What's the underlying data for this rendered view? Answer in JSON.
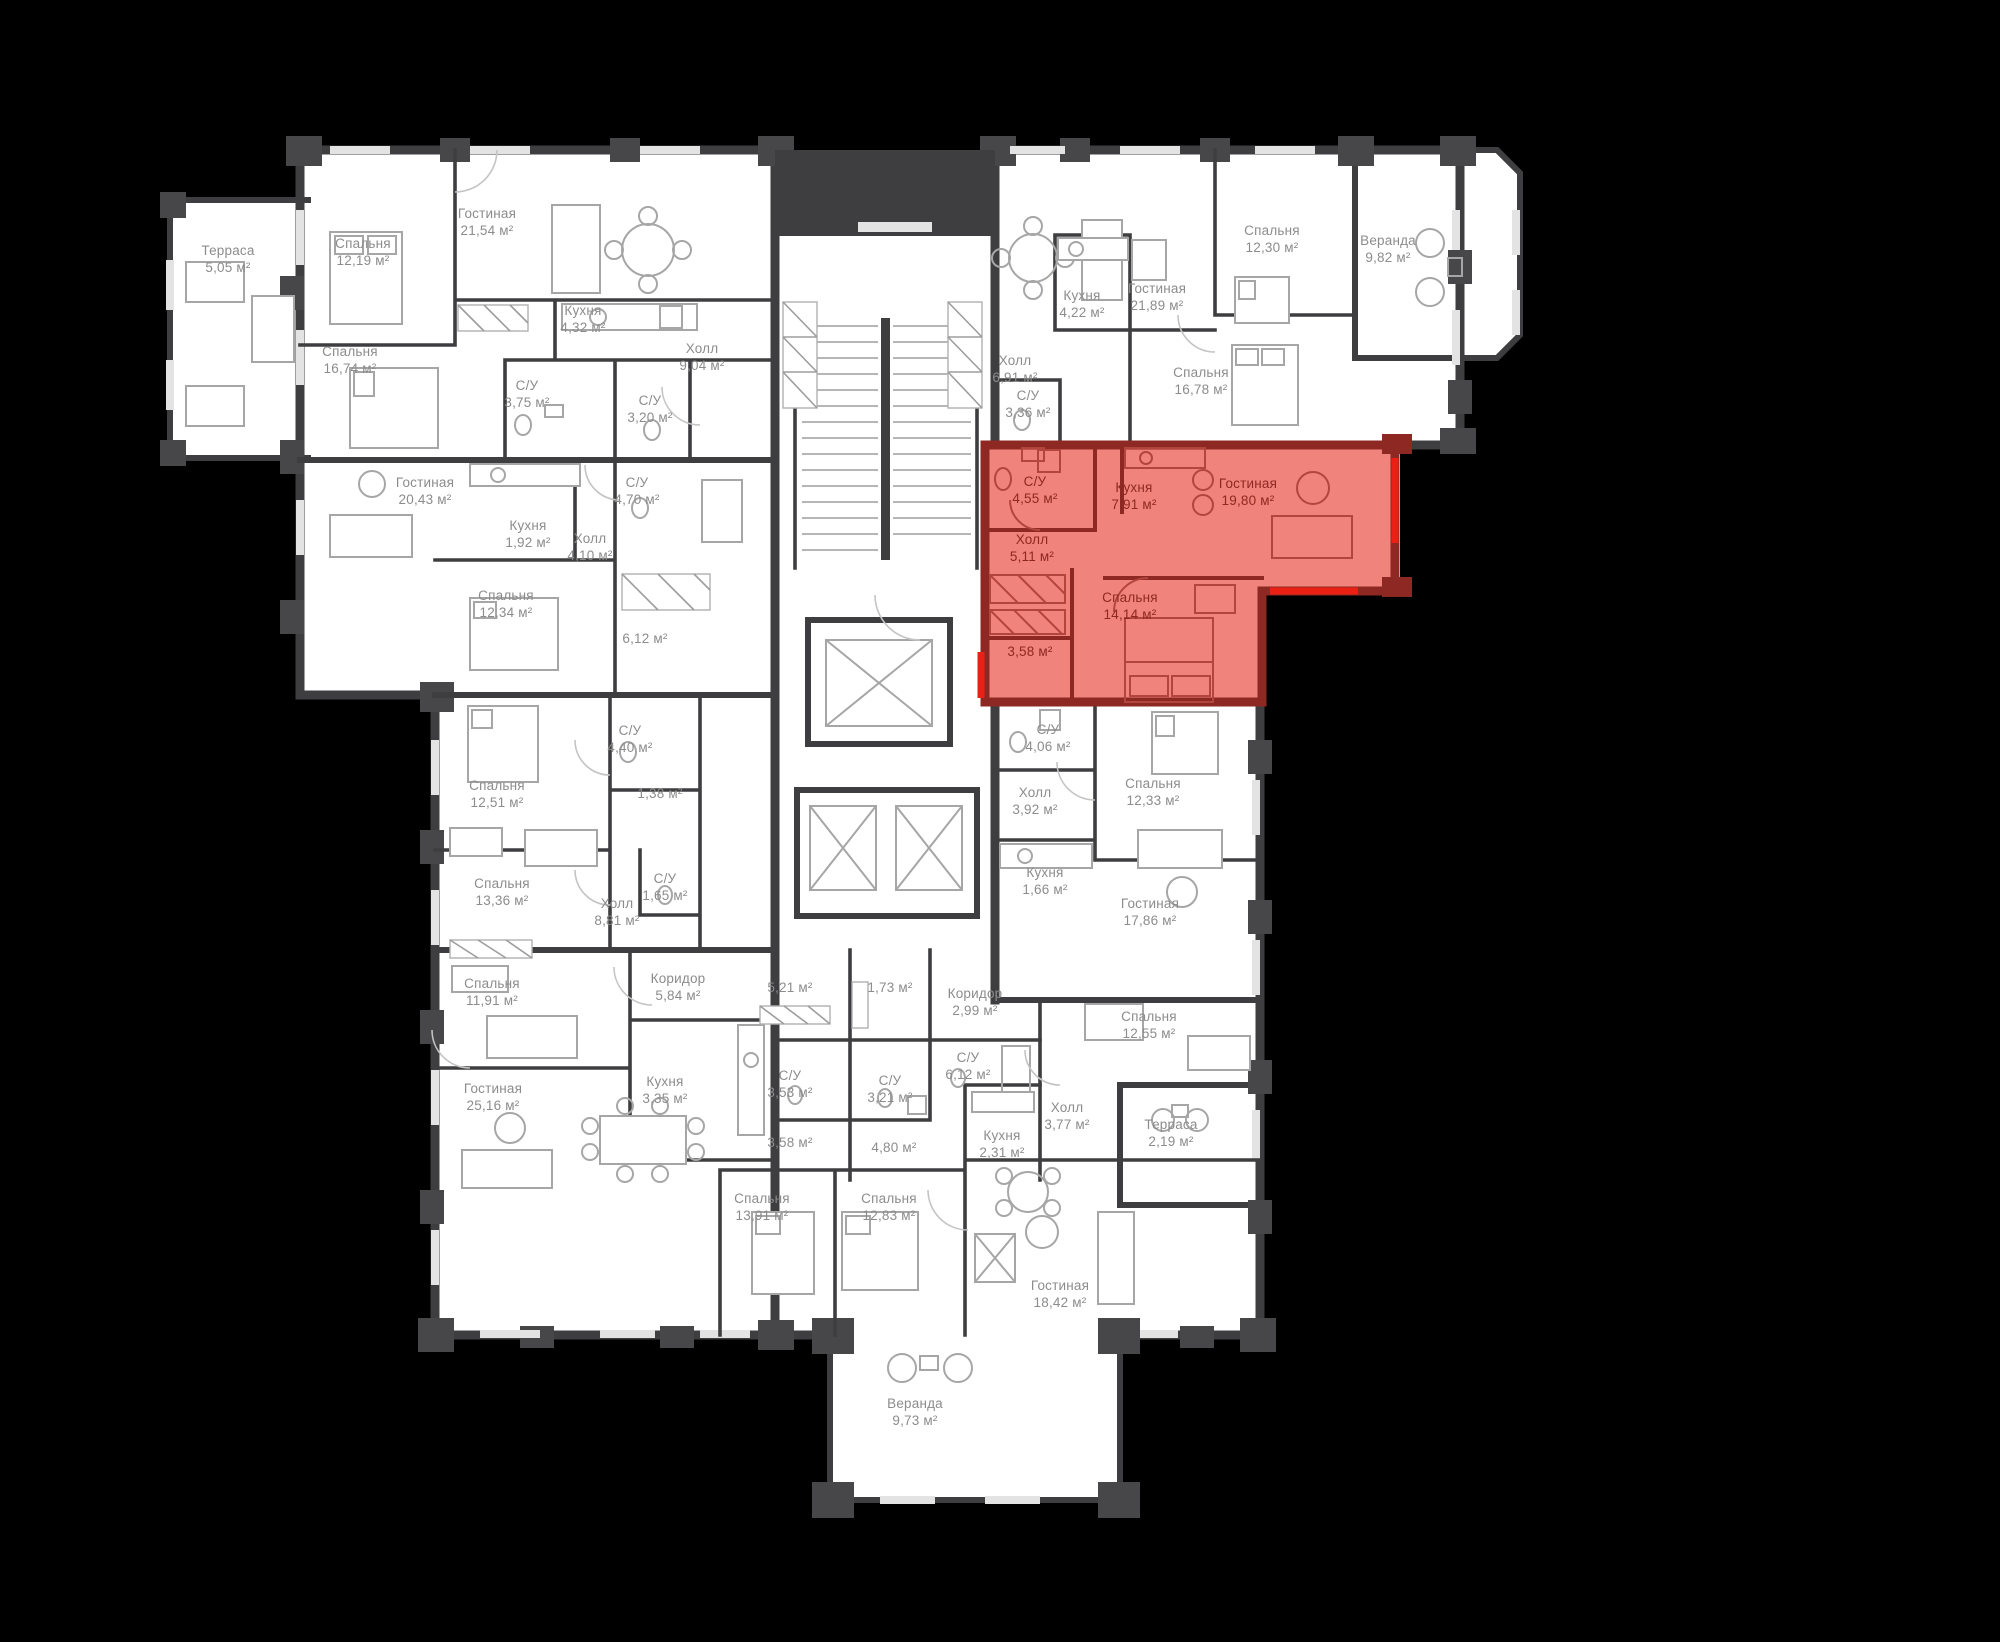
{
  "canvas": {
    "width": 2000,
    "height": 1642,
    "background": "#000000"
  },
  "colors": {
    "background": "#000000",
    "floor_fill": "#ffffff",
    "wall": "#3e3e40",
    "furniture_line": "#a6a6a6",
    "label_text": "#8c8c8c",
    "highlight_fill": "#f0837b",
    "highlight_wall": "#8e2823",
    "highlight_accent": "#ea2015",
    "highlight_label": "#8e2823",
    "highlight_furniture": "#b2453e"
  },
  "rooms": [
    {
      "name": "Терраса",
      "area": "5,05 м²",
      "x": 228,
      "y": 255
    },
    {
      "name": "Спальня",
      "area": "12,19 м²",
      "x": 363,
      "y": 248
    },
    {
      "name": "Гостиная",
      "area": "21,54 м²",
      "x": 487,
      "y": 218
    },
    {
      "name": "Спальня",
      "area": "16,74 м²",
      "x": 350,
      "y": 356
    },
    {
      "name": "Кухня",
      "area": "4,32 м²",
      "x": 583,
      "y": 315
    },
    {
      "name": "Холл",
      "area": "9,04 м²",
      "x": 702,
      "y": 353
    },
    {
      "name": "С/У",
      "area": "3,75 м²",
      "x": 527,
      "y": 390
    },
    {
      "name": "С/У",
      "area": "3,20 м²",
      "x": 650,
      "y": 405
    },
    {
      "name": "Гостиная",
      "area": "20,43 м²",
      "x": 425,
      "y": 487
    },
    {
      "name": "Кухня",
      "area": "1,92 м²",
      "x": 528,
      "y": 530
    },
    {
      "name": "С/У",
      "area": "4,70 м²",
      "x": 637,
      "y": 487
    },
    {
      "name": "Холл",
      "area": "4,10 м²",
      "x": 590,
      "y": 543
    },
    {
      "name": "Спальня",
      "area": "12,34 м²",
      "x": 506,
      "y": 600
    },
    {
      "name": "",
      "area": "6,12 м²",
      "x": 645,
      "y": 643
    },
    {
      "name": "С/У",
      "area": "4,40 м²",
      "x": 630,
      "y": 735
    },
    {
      "name": "Спальня",
      "area": "12,51 м²",
      "x": 497,
      "y": 790
    },
    {
      "name": "",
      "area": "1,38 м²",
      "x": 660,
      "y": 798
    },
    {
      "name": "С/У",
      "area": "1,65 м²",
      "x": 665,
      "y": 883
    },
    {
      "name": "Спальня",
      "area": "13,36 м²",
      "x": 502,
      "y": 888
    },
    {
      "name": "Холл",
      "area": "8,81 м²",
      "x": 617,
      "y": 908
    },
    {
      "name": "Спальня",
      "area": "11,91 м²",
      "x": 492,
      "y": 988
    },
    {
      "name": "Коридор",
      "area": "5,84 м²",
      "x": 678,
      "y": 983
    },
    {
      "name": "Гостиная",
      "area": "25,16 м²",
      "x": 493,
      "y": 1093
    },
    {
      "name": "Кухня",
      "area": "3,35 м²",
      "x": 665,
      "y": 1086
    },
    {
      "name": "",
      "area": "5,21 м²",
      "x": 790,
      "y": 992
    },
    {
      "name": "",
      "area": "1,73 м²",
      "x": 890,
      "y": 992
    },
    {
      "name": "Коридор",
      "area": "2,99 м²",
      "x": 975,
      "y": 998
    },
    {
      "name": "С/У",
      "area": "6,12 м²",
      "x": 968,
      "y": 1062
    },
    {
      "name": "С/У",
      "area": "3,53 м²",
      "x": 790,
      "y": 1080
    },
    {
      "name": "С/У",
      "area": "3,21 м²",
      "x": 890,
      "y": 1085
    },
    {
      "name": "",
      "area": "3,58 м²",
      "x": 790,
      "y": 1147
    },
    {
      "name": "",
      "area": "4,80 м²",
      "x": 894,
      "y": 1152
    },
    {
      "name": "Кухня",
      "area": "2,31 м²",
      "x": 1002,
      "y": 1140
    },
    {
      "name": "Спальня",
      "area": "13,91 м²",
      "x": 762,
      "y": 1203
    },
    {
      "name": "Спальня",
      "area": "12,83 м²",
      "x": 889,
      "y": 1203
    },
    {
      "name": "Гостиная",
      "area": "18,42 м²",
      "x": 1060,
      "y": 1290
    },
    {
      "name": "Веранда",
      "area": "9,73 м²",
      "x": 915,
      "y": 1408
    },
    {
      "name": "С/У",
      "area": "4,06 м²",
      "x": 1048,
      "y": 734
    },
    {
      "name": "Холл",
      "area": "3,92 м²",
      "x": 1035,
      "y": 797
    },
    {
      "name": "Спальня",
      "area": "12,33 м²",
      "x": 1153,
      "y": 788
    },
    {
      "name": "Кухня",
      "area": "1,66 м²",
      "x": 1045,
      "y": 877
    },
    {
      "name": "Гостиная",
      "area": "17,86 м²",
      "x": 1150,
      "y": 908
    },
    {
      "name": "Спальня",
      "area": "12,55 м²",
      "x": 1149,
      "y": 1021
    },
    {
      "name": "Холл",
      "area": "3,77 м²",
      "x": 1067,
      "y": 1112
    },
    {
      "name": "Терраса",
      "area": "2,19 м²",
      "x": 1171,
      "y": 1129
    },
    {
      "name": "Холл",
      "area": "6,91 м²",
      "x": 1015,
      "y": 365
    },
    {
      "name": "Кухня",
      "area": "4,22 м²",
      "x": 1082,
      "y": 300
    },
    {
      "name": "Гостиная",
      "area": "21,89 м²",
      "x": 1157,
      "y": 293
    },
    {
      "name": "Спальня",
      "area": "12,30 м²",
      "x": 1272,
      "y": 235
    },
    {
      "name": "Веранда",
      "area": "9,82 м²",
      "x": 1388,
      "y": 245
    },
    {
      "name": "Спальня",
      "area": "16,78 м²",
      "x": 1201,
      "y": 377
    },
    {
      "name": "С/У",
      "area": "3,36 м²",
      "x": 1028,
      "y": 400
    }
  ],
  "highlight": {
    "rooms": [
      {
        "name": "С/У",
        "area": "4,55 м²",
        "x": 1035,
        "y": 486
      },
      {
        "name": "Кухня",
        "area": "7,91 м²",
        "x": 1134,
        "y": 492
      },
      {
        "name": "Гостиная",
        "area": "19,80 м²",
        "x": 1248,
        "y": 488
      },
      {
        "name": "Холл",
        "area": "5,11 м²",
        "x": 1032,
        "y": 544
      },
      {
        "name": "Спальня",
        "area": "14,14 м²",
        "x": 1130,
        "y": 602
      },
      {
        "name": "",
        "area": "3,58 м²",
        "x": 1030,
        "y": 656
      }
    ]
  }
}
